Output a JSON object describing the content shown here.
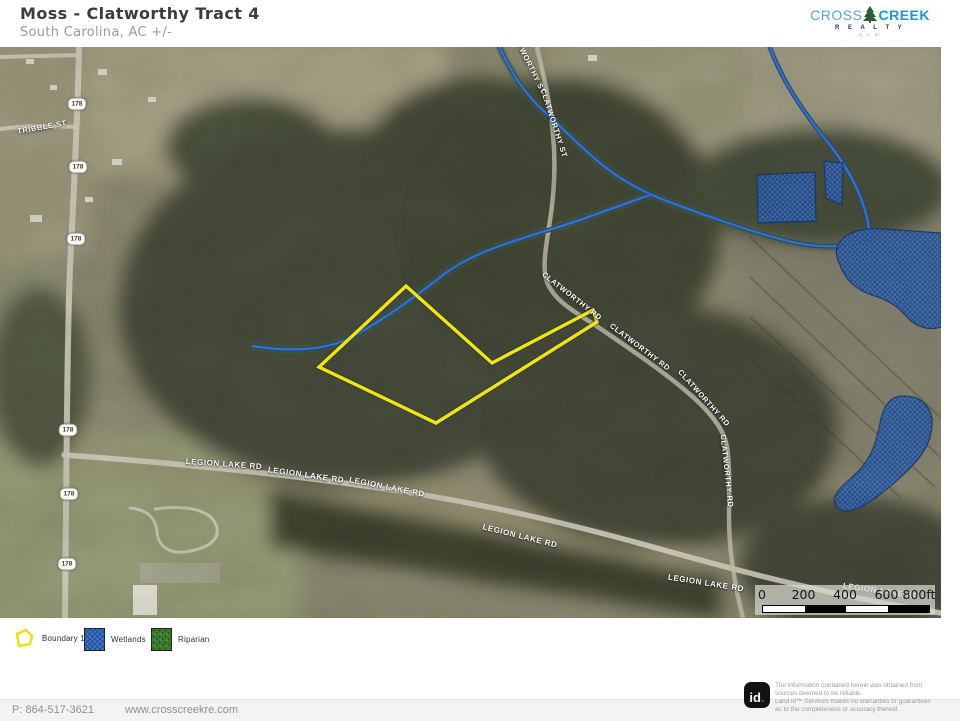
{
  "header": {
    "title": "Moss - Clatworthy  Tract 4",
    "subtitle": "South Carolina,  AC +/-",
    "logo": {
      "word1": "CROSS",
      "word2": "CREEK",
      "line2": "R E A L T Y",
      "line3": "L L C",
      "colors": {
        "cross": "#5aa8c2",
        "creek": "#129bd8",
        "realty": "#17395c",
        "tree": "#2d5c39"
      }
    }
  },
  "map": {
    "road_labels": [
      {
        "text": "TRIBBLE ST",
        "x": 42,
        "y": 80,
        "rot": -10,
        "size": 7.5
      },
      {
        "text": "CLATWORTHY ST",
        "x": 528,
        "y": 14,
        "rot": 64,
        "size": 7.5
      },
      {
        "text": "CLATWORTHY ST",
        "x": 554,
        "y": 76,
        "rot": 72,
        "size": 7.5
      },
      {
        "text": "CLATWORTHY RD",
        "x": 572,
        "y": 249,
        "rot": 38,
        "size": 7.5
      },
      {
        "text": "CLATWORTHY RD",
        "x": 640,
        "y": 300,
        "rot": 37,
        "size": 7.5
      },
      {
        "text": "CLATWORTHY RD",
        "x": 704,
        "y": 351,
        "rot": 48,
        "size": 7.5
      },
      {
        "text": "CLATWORTHY RD",
        "x": 727,
        "y": 424,
        "rot": 84,
        "size": 7.5
      },
      {
        "text": "LEGION LAKE RD",
        "x": 224,
        "y": 417,
        "rot": 4,
        "size": 8
      },
      {
        "text": "LEGION LAKE RD",
        "x": 306,
        "y": 428,
        "rot": 8,
        "size": 8
      },
      {
        "text": "LEGION LAKE RD",
        "x": 387,
        "y": 440,
        "rot": 11,
        "size": 8
      },
      {
        "text": "LEGION LAKE RD",
        "x": 520,
        "y": 489,
        "rot": 14,
        "size": 8
      },
      {
        "text": "LEGION LAKE RD",
        "x": 706,
        "y": 536,
        "rot": 9,
        "size": 8
      },
      {
        "text": "LEGION LAKE RD",
        "x": 881,
        "y": 544,
        "rot": 8,
        "size": 8
      }
    ],
    "route_shields": [
      {
        "label": "178",
        "x": 77,
        "y": 57
      },
      {
        "label": "178",
        "x": 78,
        "y": 120
      },
      {
        "label": "178",
        "x": 76,
        "y": 192
      },
      {
        "label": "178",
        "x": 68,
        "y": 383
      },
      {
        "label": "178",
        "x": 69,
        "y": 447
      },
      {
        "label": "178",
        "x": 67,
        "y": 517
      }
    ],
    "boundary": {
      "name": "Boundary 1",
      "color": "#ede41e",
      "points": "406,239 492,316 593,263 597,275 436,376 319,320"
    },
    "scale_bar": {
      "ticks": [
        "0",
        "200",
        "400",
        "600",
        "800ft"
      ],
      "segment_colors": [
        "#ffffff",
        "#000000",
        "#ffffff",
        "#000000"
      ]
    },
    "colors": {
      "wetland": "#3f78cc",
      "stream": "#2f63b0",
      "forest": "#494e3c",
      "field": "#a9a58c"
    }
  },
  "legend": {
    "items": [
      {
        "label": "Boundary 1"
      },
      {
        "label": "Wetlands"
      },
      {
        "label": "Riparian"
      }
    ]
  },
  "footer": {
    "phone": "P: 864-517-3621",
    "website": "www.crosscreekre.com",
    "id_text": "id",
    "id_dot": ".",
    "disclaimer": [
      "The information contained herein was obtained from",
      "sources deemed to be reliable.",
      "Land id™  Services makes no warranties or guarantees",
      "as to the completeness or accuracy thereof."
    ]
  }
}
